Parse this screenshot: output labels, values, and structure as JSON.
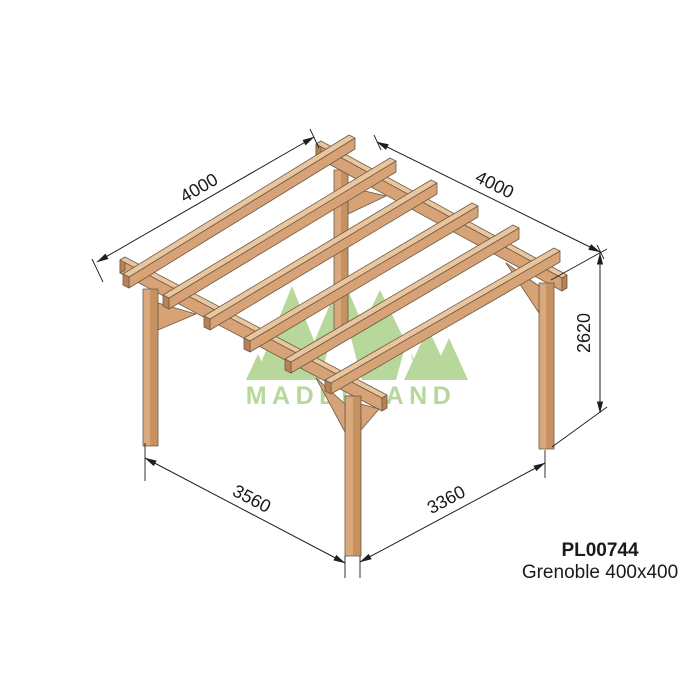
{
  "product": {
    "code": "PL00744",
    "name": "Grenoble 400x400"
  },
  "brand": {
    "wordmark": "MADERLAND"
  },
  "dimensions": {
    "roof_depth_left": "4000",
    "roof_width_right": "4000",
    "height": "2620",
    "base_left": "3560",
    "base_right": "3360"
  },
  "colors": {
    "wood_top": "#eac59d",
    "wood_mid": "#d7a376",
    "wood_dark": "#ba8156",
    "post_light": "#d9a87c",
    "post_dark": "#c79260",
    "outline": "#6a5a48",
    "dim_line": "#1f1f1f",
    "text_color": "#1a1a1a",
    "watermark_green": "#b7d79b"
  }
}
